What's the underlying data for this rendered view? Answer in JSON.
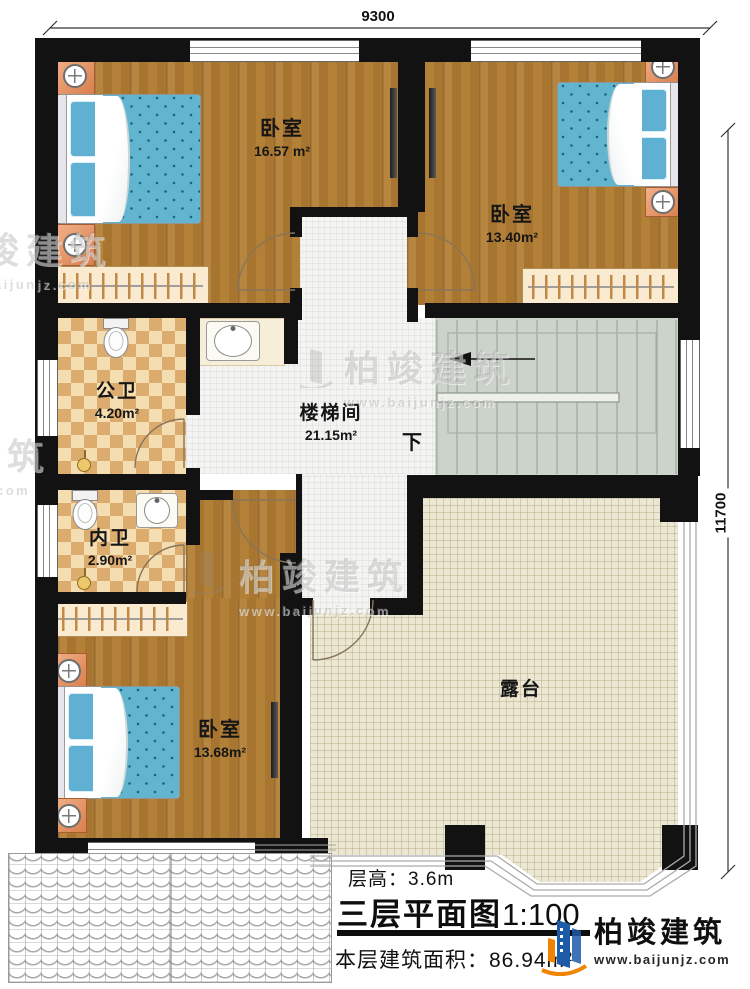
{
  "dimensions": {
    "top": "9300",
    "right": "11700"
  },
  "rooms": {
    "bedroom1": {
      "name": "卧室",
      "area": "16.57 m²"
    },
    "bedroom2": {
      "name": "卧室",
      "area": "13.40m²"
    },
    "bedroom3": {
      "name": "卧室",
      "area": "13.68m²"
    },
    "public_bath": {
      "name": "公卫",
      "area": "4.20m²"
    },
    "inner_bath": {
      "name": "内卫",
      "area": "2.90m²"
    },
    "stairwell": {
      "name": "楼梯间",
      "area": "21.15m²",
      "direction": "下"
    },
    "terrace": {
      "name": "露台"
    }
  },
  "footer": {
    "floor_height": "层高：3.6m",
    "title": "三层平面图",
    "scale": "1:100",
    "area": "本层建筑面积：86.94m²"
  },
  "brand": {
    "name": "柏竣建筑",
    "url": "www.baijunjz.com"
  },
  "watermark": {
    "name": "柏竣建筑",
    "url": "www.baijunjz.com"
  },
  "colors": {
    "wall": "#121212",
    "wood": "#b17c32",
    "bath_tile": "#e9c088",
    "hall_tile": "#f3f3f1",
    "terrace": "#ebe7d3",
    "stairs": "#ccd3ca",
    "bed": "#62b5ce",
    "accent_blue": "#1d5ba8",
    "accent_orange": "#f08300"
  }
}
